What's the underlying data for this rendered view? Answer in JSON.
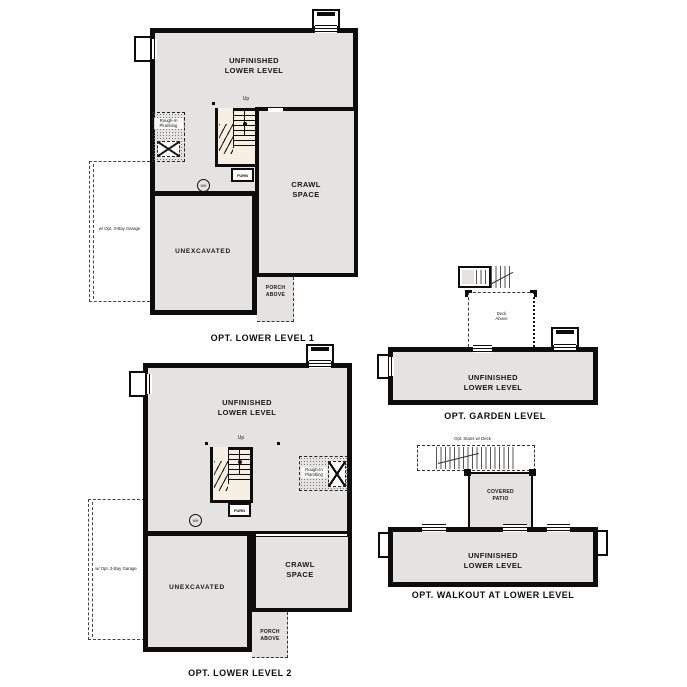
{
  "colors": {
    "paper": "#ffffff",
    "floor": "#e4e3e2",
    "wall": "#0d0d0d",
    "stair_floor": "#f7f0e2"
  },
  "labels": {
    "unfinished": "UNFINISHED\nLOWER LEVEL",
    "crawl": "CRAWL\nSPACE",
    "unexcavated": "UNEXCAVATED",
    "porch": "PORCH\nABOVE",
    "patio": "COVERED\nPATIO",
    "deck_above": "Deck\nAbove",
    "rough_in": "Rough-In\nPlumbing",
    "up": "Up",
    "furn": "FURN",
    "wh": "WH",
    "garage_note": "w/ Opt. 3-Bay Garage",
    "stairs_deck_note": "Opt. Stairs w/ Deck"
  },
  "plans": {
    "lower_level_1": {
      "caption": "OPT. LOWER LEVEL 1"
    },
    "lower_level_2": {
      "caption": "OPT. LOWER LEVEL 2"
    },
    "garden_level": {
      "caption": "OPT. GARDEN LEVEL"
    },
    "walkout": {
      "caption": "OPT. WALKOUT AT LOWER LEVEL"
    }
  }
}
